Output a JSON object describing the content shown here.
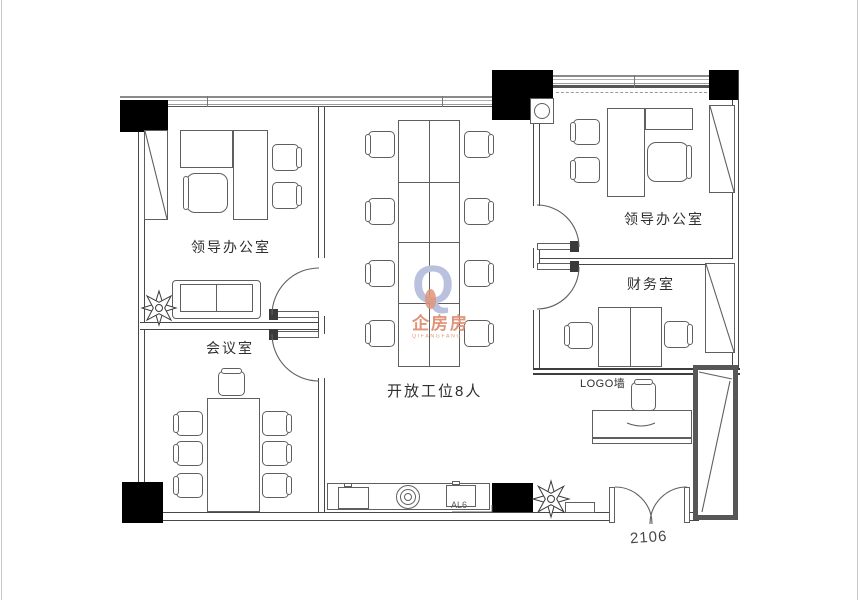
{
  "rooms": {
    "leader_left": "领导办公室",
    "meeting": "会议室",
    "open_area": "开放工位8人",
    "leader_right": "领导办公室",
    "finance": "财务室"
  },
  "annotations": {
    "logo_wall": "LOGO墙",
    "al6": "AL6",
    "unit_number": "2106"
  },
  "watermark": {
    "logo_letter": "Q",
    "brand": "企房房",
    "pinyin": "QIFANGFANG"
  },
  "colors": {
    "wall_line": "#474747",
    "furniture_line": "#5f5f5f",
    "column_fill": "#000000",
    "shaft_wall": "#575757",
    "watermark_logo": "#b9c1de",
    "watermark_text": "#e0947a"
  }
}
